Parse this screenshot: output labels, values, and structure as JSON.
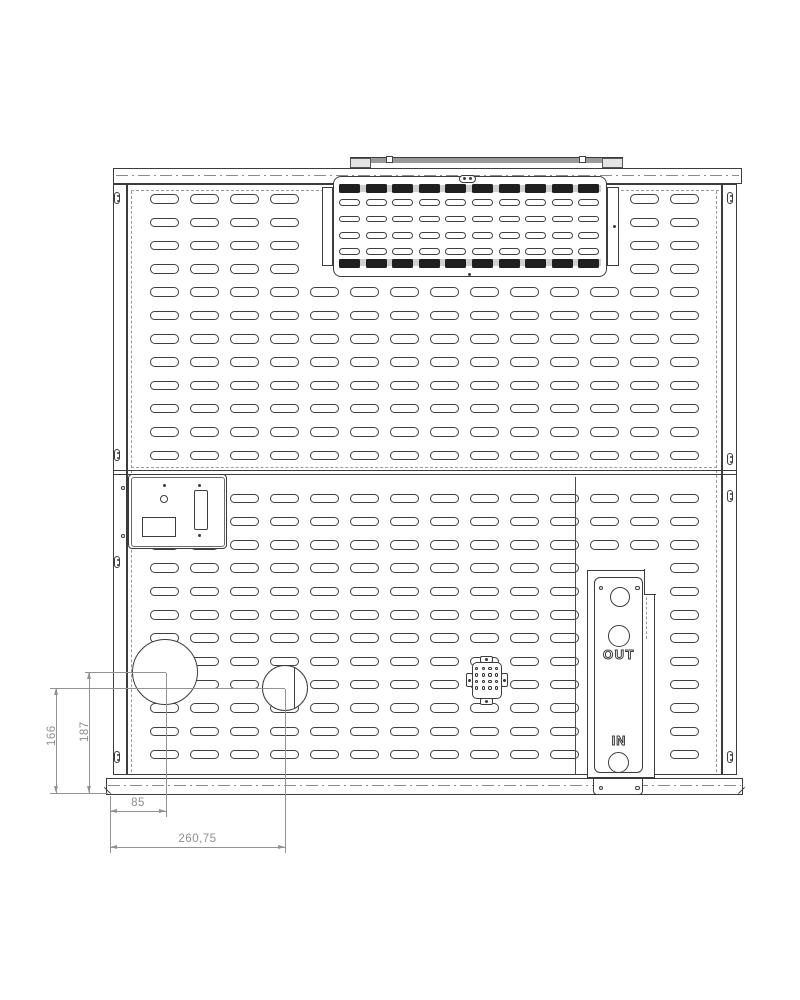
{
  "labels": {
    "out": "OUT",
    "in": "IN"
  },
  "dimensions": {
    "d166": "166",
    "d187": "187",
    "d85": "85",
    "d260": "260,75"
  },
  "colors": {
    "line": "#3c3c3c",
    "dimension_gray": "#929292",
    "grille_slot_fill": "#1f1f1f",
    "bracket_gray": "#9a9a9a"
  }
}
